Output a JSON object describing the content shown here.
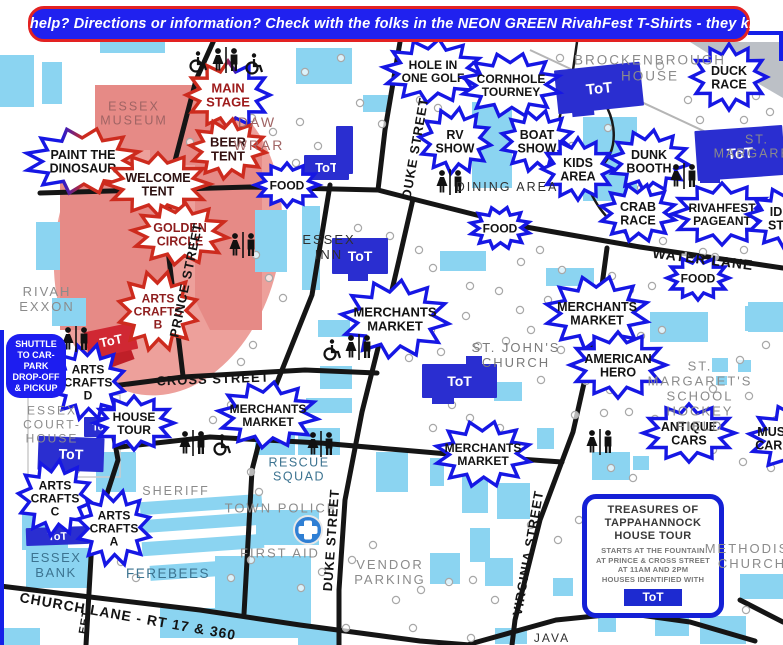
{
  "banner": {
    "text": "Need help? Directions or information? Check with the folks in the NEON GREEN RivahFest T-Shirts - they know!!"
  },
  "tot_label": "ToT",
  "colors": {
    "badge_blue": "#1617e4",
    "badge_red": "#cd2b1e",
    "tot_blue": "#2a2ed0",
    "tot_red": "#d02833",
    "building_blue": "#8bd4f1",
    "festival_pink": "#eda09b",
    "festival_dark_pink": "#e68a86",
    "banner_bg": "#2021ef",
    "banner_border": "#e32222",
    "first_aid_blue": "#2f7fd4"
  },
  "legend": {
    "shuttle_box": {
      "lines": [
        "SHUTTLE",
        "TO CAR-",
        "PARK",
        "DROP-OFF",
        "& PICKUP"
      ]
    },
    "tour_box": {
      "title_lines": [
        "TREASURES OF",
        "TAPPAHANNOCK",
        "HOUSE TOUR"
      ],
      "body_lines": [
        "STARTS AT THE FOUNTAIN",
        "AT PRINCE & CROSS STREET",
        "AT 11AM AND 2PM",
        "HOUSES IDENTIFIED WITH"
      ],
      "badge_label": "ToT"
    }
  },
  "badges": [
    {
      "id": "main-stage",
      "lines": [
        "MAIN",
        "STAGE"
      ],
      "x": 228,
      "y": 95,
      "rx": 42,
      "ry": 34,
      "style": "grad-ms",
      "text_color": "#9e1b1b",
      "font_size": 13
    },
    {
      "id": "beer-tent",
      "lines": [
        "BEER",
        "TENT"
      ],
      "x": 228,
      "y": 149,
      "rx": 38,
      "ry": 30,
      "style": "red",
      "text_color": "#351212",
      "font_size": 13
    },
    {
      "id": "paint-the-dinosaur",
      "lines": [
        "PAINT THE",
        "DINOSAUR"
      ],
      "x": 83,
      "y": 161,
      "rx": 58,
      "ry": 33,
      "style": "grad-pd",
      "text_color": "#141414",
      "font_size": 12.5
    },
    {
      "id": "welcome-tent",
      "lines": [
        "WELCOME",
        "TENT"
      ],
      "x": 158,
      "y": 184,
      "rx": 52,
      "ry": 31,
      "style": "red",
      "text_color": "#2c1010",
      "font_size": 12.5
    },
    {
      "id": "golden-circle",
      "lines": [
        "GOLDEN",
        "CIRCLE"
      ],
      "x": 180,
      "y": 234,
      "rx": 48,
      "ry": 31,
      "style": "red",
      "text_color": "#8e1d1d",
      "font_size": 12.5
    },
    {
      "id": "arts-crafts-b",
      "lines": [
        "ARTS",
        "CRAFTS",
        "B"
      ],
      "x": 158,
      "y": 311,
      "rx": 40,
      "ry": 40,
      "style": "red",
      "text_color": "#8e1d1d",
      "font_size": 12
    },
    {
      "id": "food-1",
      "lines": [
        "FOOD"
      ],
      "x": 287,
      "y": 185,
      "rx": 32,
      "ry": 22,
      "style": "blue",
      "text_color": "#141414",
      "font_size": 12
    },
    {
      "id": "hole-in-one-golf",
      "lines": [
        "HOLE IN",
        "ONE GOLF"
      ],
      "x": 433,
      "y": 71,
      "rx": 50,
      "ry": 32,
      "style": "blue",
      "text_color": "#141414",
      "font_size": 12
    },
    {
      "id": "cornhole-tourney",
      "lines": [
        "CORNHOLE",
        "TOURNEY"
      ],
      "x": 511,
      "y": 85,
      "rx": 50,
      "ry": 32,
      "style": "blue",
      "text_color": "#141414",
      "font_size": 12
    },
    {
      "id": "duck-race",
      "lines": [
        "DUCK",
        "RACE"
      ],
      "x": 729,
      "y": 77,
      "rx": 38,
      "ry": 33,
      "style": "blue",
      "text_color": "#141414",
      "font_size": 12.5
    },
    {
      "id": "rv-show",
      "lines": [
        "RV",
        "SHOW"
      ],
      "x": 455,
      "y": 141,
      "rx": 36,
      "ry": 33,
      "style": "blue",
      "text_color": "#141414",
      "font_size": 12.5
    },
    {
      "id": "boat-show",
      "lines": [
        "BOAT",
        "SHOW"
      ],
      "x": 537,
      "y": 141,
      "rx": 36,
      "ry": 31,
      "style": "blue",
      "text_color": "#141414",
      "font_size": 12.5
    },
    {
      "id": "kids-area",
      "lines": [
        "KIDS",
        "AREA"
      ],
      "x": 578,
      "y": 169,
      "rx": 36,
      "ry": 31,
      "style": "blue",
      "text_color": "#141414",
      "font_size": 12.5
    },
    {
      "id": "dunk-booth",
      "lines": [
        "DUNK",
        "BOOTH"
      ],
      "x": 649,
      "y": 161,
      "rx": 40,
      "ry": 31,
      "style": "blue",
      "text_color": "#141414",
      "font_size": 12.5
    },
    {
      "id": "crab-race",
      "lines": [
        "CRAB",
        "RACE"
      ],
      "x": 638,
      "y": 213,
      "rx": 38,
      "ry": 29,
      "style": "blue",
      "text_color": "#141414",
      "font_size": 12.5
    },
    {
      "id": "rivahfest-pageant",
      "lines": [
        "RIVAHFEST",
        "PAGEANT"
      ],
      "x": 722,
      "y": 214,
      "rx": 50,
      "ry": 31,
      "style": "blue",
      "text_color": "#141414",
      "font_size": 12
    },
    {
      "id": "id-st",
      "lines": [
        "ID",
        "ST"
      ],
      "x": 789,
      "y": 218,
      "rx": 42,
      "ry": 31,
      "style": "blue",
      "text_color": "#141414",
      "font_size": 12.5,
      "text_x": 776
    },
    {
      "id": "food-2",
      "lines": [
        "FOOD"
      ],
      "x": 500,
      "y": 228,
      "rx": 30,
      "ry": 21,
      "style": "blue",
      "text_color": "#141414",
      "font_size": 12
    },
    {
      "id": "food-3",
      "lines": [
        "FOOD"
      ],
      "x": 698,
      "y": 278,
      "rx": 31,
      "ry": 22,
      "style": "blue",
      "text_color": "#141414",
      "font_size": 12
    },
    {
      "id": "merchants-market-1",
      "lines": [
        "MERCHANTS",
        "MARKET"
      ],
      "x": 395,
      "y": 319,
      "rx": 54,
      "ry": 39,
      "style": "blue",
      "text_color": "#141414",
      "font_size": 13
    },
    {
      "id": "merchants-market-2",
      "lines": [
        "MERCHANTS",
        "MARKET"
      ],
      "x": 597,
      "y": 313,
      "rx": 52,
      "ry": 37,
      "style": "blue",
      "text_color": "#141414",
      "font_size": 12.5
    },
    {
      "id": "american-hero",
      "lines": [
        "AMERICAN",
        "HERO"
      ],
      "x": 618,
      "y": 365,
      "rx": 48,
      "ry": 33,
      "style": "blue",
      "text_color": "#141414",
      "font_size": 12.5
    },
    {
      "id": "merchants-market-3",
      "lines": [
        "MERCHANTS",
        "MARKET"
      ],
      "x": 268,
      "y": 415,
      "rx": 50,
      "ry": 33,
      "style": "blue",
      "text_color": "#141414",
      "font_size": 12
    },
    {
      "id": "merchants-market-4",
      "lines": [
        "MERCHANTS",
        "MARKET"
      ],
      "x": 483,
      "y": 454,
      "rx": 48,
      "ry": 33,
      "style": "blue",
      "text_color": "#141414",
      "font_size": 12
    },
    {
      "id": "antique-cars",
      "lines": [
        "ANTIQUE",
        "CARS"
      ],
      "x": 689,
      "y": 433,
      "rx": 46,
      "ry": 29,
      "style": "blue",
      "text_color": "#141414",
      "font_size": 12.5
    },
    {
      "id": "must-car",
      "lines": [
        "MUST",
        "CAR C"
      ],
      "x": 797,
      "y": 438,
      "rx": 48,
      "ry": 34,
      "style": "blue",
      "text_color": "#141414",
      "font_size": 12.5,
      "text_x": 775
    },
    {
      "id": "arts-crafts-d",
      "lines": [
        "ARTS",
        "CRAFTS",
        "D"
      ],
      "x": 88,
      "y": 382,
      "rx": 37,
      "ry": 38,
      "style": "blue",
      "text_color": "#141414",
      "font_size": 12
    },
    {
      "id": "house-tour",
      "lines": [
        "HOUSE",
        "TOUR"
      ],
      "x": 134,
      "y": 423,
      "rx": 40,
      "ry": 27,
      "style": "blue",
      "text_color": "#141414",
      "font_size": 12
    },
    {
      "id": "arts-crafts-c",
      "lines": [
        "ARTS",
        "CRAFTS",
        "C"
      ],
      "x": 55,
      "y": 498,
      "rx": 37,
      "ry": 38,
      "style": "blue",
      "text_color": "#141414",
      "font_size": 12
    },
    {
      "id": "arts-crafts-a",
      "lines": [
        "ARTS",
        "CRAFTS",
        "A"
      ],
      "x": 114,
      "y": 528,
      "rx": 37,
      "ry": 38,
      "style": "blue",
      "text_color": "#141414",
      "font_size": 12
    }
  ],
  "tot_signs": [
    {
      "id": "tot-duke",
      "x": 304,
      "y": 155,
      "w": 45,
      "h": 25,
      "rot": 0,
      "variant": "blue",
      "show_label": true,
      "font_size": 13
    },
    {
      "id": "tot-brockenbrough",
      "x": 556,
      "y": 66,
      "w": 86,
      "h": 44,
      "rot": -6,
      "variant": "blue",
      "show_label": true,
      "font_size": 15
    },
    {
      "id": "tot-st-margarets",
      "x": 696,
      "y": 128,
      "w": 88,
      "h": 50,
      "rot": -4,
      "variant": "blue",
      "show_label": true,
      "font_size": 15
    },
    {
      "id": "tot-essex-inn",
      "x": 332,
      "y": 238,
      "w": 56,
      "h": 36,
      "rot": 0,
      "variant": "blue",
      "show_label": true,
      "font_size": 14
    },
    {
      "id": "tot-st-johns",
      "x": 422,
      "y": 364,
      "w": 75,
      "h": 34,
      "rot": 0,
      "variant": "blue",
      "show_label": true,
      "font_size": 14
    },
    {
      "id": "tot-golden-circle",
      "x": 86,
      "y": 327,
      "w": 50,
      "h": 27,
      "rot": -12,
      "variant": "red",
      "show_label": true,
      "font_size": 13
    },
    {
      "id": "tot-courthouse-small",
      "x": 84,
      "y": 417,
      "w": 34,
      "h": 20,
      "rot": 0,
      "variant": "blue",
      "show_label": true,
      "font_size": 10
    },
    {
      "id": "tot-courthouse",
      "x": 38,
      "y": 437,
      "w": 66,
      "h": 34,
      "rot": 2,
      "variant": "blue",
      "show_label": true,
      "font_size": 14
    },
    {
      "id": "tot-essex-bank",
      "x": 26,
      "y": 527,
      "w": 63,
      "h": 18,
      "rot": -2,
      "variant": "blue",
      "show_label": true,
      "font_size": 11
    },
    {
      "id": "tot-tour-badge-map",
      "x": 587,
      "y": 596,
      "w": 120,
      "h": 13,
      "rot": 0,
      "variant": "blue",
      "show_label": false,
      "font_size": 0
    },
    {
      "id": "building-duke-blue",
      "x": 336,
      "y": 126,
      "w": 17,
      "h": 48,
      "rot": 0,
      "variant": "blue",
      "show_label": false,
      "font_size": 0
    }
  ],
  "landmark_labels": [
    {
      "id": "essex-museum",
      "lines": [
        "ESSEX",
        "MUSEUM"
      ],
      "x": 134,
      "y": 114,
      "style": "mus",
      "size": 12.5
    },
    {
      "id": "daw",
      "lines": [
        "DAW"
      ],
      "x": 257,
      "y": 122,
      "style": "mus",
      "size": 14
    },
    {
      "id": "wrar",
      "lines": [
        "WRAR"
      ],
      "x": 259,
      "y": 145,
      "style": "mus",
      "size": 14
    },
    {
      "id": "rivah-exxon",
      "lines": [
        "RIVAH",
        "EXXON"
      ],
      "x": 47,
      "y": 300,
      "style": "gray",
      "size": 13
    },
    {
      "id": "essex-inn",
      "lines": [
        "ESSEX",
        "INN"
      ],
      "x": 329,
      "y": 248,
      "style": "dark",
      "size": 13
    },
    {
      "id": "dining-area",
      "lines": [
        "DINING AREA"
      ],
      "x": 507,
      "y": 187,
      "style": "dark",
      "size": 12.5
    },
    {
      "id": "brockenbrough-house",
      "lines": [
        "BROCKENBROUGH",
        "HOUSE"
      ],
      "x": 650,
      "y": 68,
      "style": "gray",
      "size": 13.5
    },
    {
      "id": "st-margaret",
      "lines": [
        "ST. MARGARET"
      ],
      "x": 757,
      "y": 147,
      "style": "gray",
      "size": 12.5
    },
    {
      "id": "st-johns-church",
      "lines": [
        "ST. JOHN'S",
        "CHURCH"
      ],
      "x": 516,
      "y": 356,
      "style": "gray2",
      "size": 13
    },
    {
      "id": "st-margarets-school",
      "lines": [
        "ST. MARGARET'S SCHOOL",
        "HOCKEY FIELD"
      ],
      "x": 700,
      "y": 397,
      "style": "gray",
      "size": 13
    },
    {
      "id": "essex-courthouse",
      "lines": [
        "ESSEX",
        "COURT-",
        "HOUSE"
      ],
      "x": 52,
      "y": 425,
      "style": "gray",
      "size": 12
    },
    {
      "id": "sheriff",
      "lines": [
        "SHERIFF"
      ],
      "x": 176,
      "y": 491,
      "style": "gray",
      "size": 12.5
    },
    {
      "id": "essex-bank",
      "lines": [
        "ESSEX",
        "BANK"
      ],
      "x": 56,
      "y": 566,
      "style": "steel",
      "size": 13
    },
    {
      "id": "ferebees",
      "lines": [
        "FEREBEES"
      ],
      "x": 168,
      "y": 574,
      "style": "steel",
      "size": 13.5
    },
    {
      "id": "town-police",
      "lines": [
        "TOWN POLICE"
      ],
      "x": 281,
      "y": 509,
      "style": "gray",
      "size": 13
    },
    {
      "id": "first-aid",
      "lines": [
        "FIRST AID"
      ],
      "x": 280,
      "y": 554,
      "style": "gray",
      "size": 13
    },
    {
      "id": "rescue-squad",
      "lines": [
        "RESCUE",
        "SQUAD"
      ],
      "x": 299,
      "y": 470,
      "style": "steel",
      "size": 12.5
    },
    {
      "id": "vendor-parking",
      "lines": [
        "VENDOR",
        "PARKING"
      ],
      "x": 390,
      "y": 573,
      "style": "gray",
      "size": 13
    },
    {
      "id": "methodist-church",
      "lines": [
        "METHODIST",
        "CHURCH"
      ],
      "x": 752,
      "y": 557,
      "style": "gray",
      "size": 13
    },
    {
      "id": "java",
      "lines": [
        "JAVA"
      ],
      "x": 552,
      "y": 639,
      "style": "dark",
      "size": 12
    }
  ],
  "street_labels": [
    {
      "id": "duke-street-n",
      "text": "DUKE STREET",
      "x": 415,
      "y": 148,
      "rot": -80,
      "size": 13
    },
    {
      "id": "duke-street-s",
      "text": "DUKE STREET",
      "x": 331,
      "y": 540,
      "rot": -86,
      "size": 13
    },
    {
      "id": "prince-street",
      "text": "PRINCE STREET",
      "x": 186,
      "y": 280,
      "rot": -78,
      "size": 13
    },
    {
      "id": "cross-street",
      "text": "CROSS STREET",
      "x": 213,
      "y": 379,
      "rot": -2,
      "size": 13
    },
    {
      "id": "water-lane",
      "text": "WATER LANE",
      "x": 703,
      "y": 259,
      "rot": 7,
      "size": 14
    },
    {
      "id": "church-lane",
      "text": "CHURCH LANE - RT 17 & 360",
      "x": 128,
      "y": 616,
      "rot": 10,
      "size": 14
    },
    {
      "id": "virginia-street",
      "text": "VIRGINIA STREET",
      "x": 528,
      "y": 553,
      "rot": -80,
      "size": 13
    },
    {
      "id": "street-partial",
      "text": "EET",
      "x": 85,
      "y": 622,
      "rot": -80,
      "size": 11
    }
  ],
  "map_icons": [
    {
      "type": "restroom-pair",
      "x": 226,
      "y": 60
    },
    {
      "type": "wheelchair",
      "x": 197,
      "y": 62
    },
    {
      "type": "wheelchair",
      "x": 253,
      "y": 64
    },
    {
      "type": "restroom-pair",
      "x": 450,
      "y": 182
    },
    {
      "type": "restroom-pair",
      "x": 684,
      "y": 176
    },
    {
      "type": "restroom-pair",
      "x": 243,
      "y": 245
    },
    {
      "type": "restroom-pair",
      "x": 359,
      "y": 347
    },
    {
      "type": "wheelchair",
      "x": 331,
      "y": 350
    },
    {
      "type": "restroom-pair",
      "x": 76,
      "y": 339
    },
    {
      "type": "restroom-pair",
      "x": 193,
      "y": 443
    },
    {
      "type": "wheelchair",
      "x": 221,
      "y": 445
    },
    {
      "type": "restroom-pair",
      "x": 321,
      "y": 444
    },
    {
      "type": "restroom-pair",
      "x": 600,
      "y": 442
    },
    {
      "type": "first-aid",
      "x": 308,
      "y": 530
    }
  ]
}
